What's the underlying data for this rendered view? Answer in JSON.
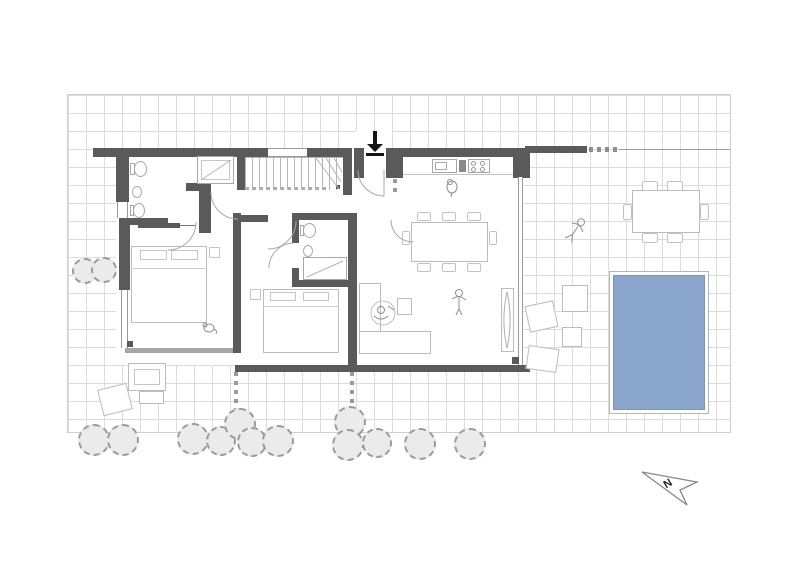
{
  "plan": {
    "type": "architectural-floor-plan",
    "north_label": "N",
    "colors": {
      "background": "#ffffff",
      "grid_line": "#dcdcdc",
      "wall": "#5a5a5a",
      "glass_wall": "#9a9a9a",
      "furniture_outline": "#bcbcbc",
      "pool_water": "#8ba6cd",
      "pool_rim": "#b5b5b5",
      "tree_fill": "#ebebeb",
      "tree_stroke": "#9b9b9b",
      "entry_arrow": "#151515",
      "north_arrow_stroke": "#888888"
    }
  }
}
